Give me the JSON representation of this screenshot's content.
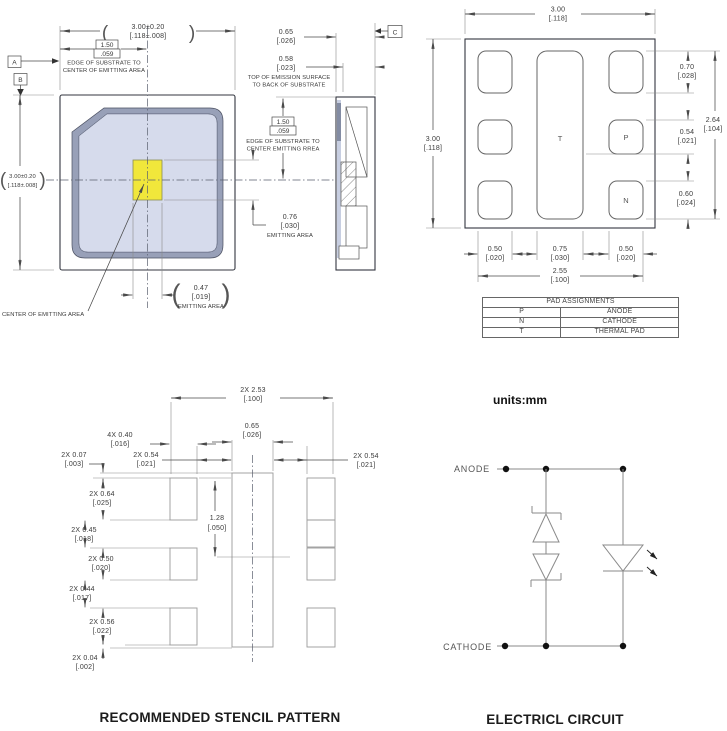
{
  "glyphs": {
    "po": "(",
    "pc": ")"
  },
  "top_view": {
    "datum_a": "A",
    "datum_b": "B",
    "dim_w": {
      "l1": "3.00±0.20",
      "l2": "[.118±.008]"
    },
    "dim_h": {
      "l1": "3.00±0.20",
      "l2": "[.118±.008]"
    },
    "edge_dim": {
      "l1": "1.50",
      "l2": ".059",
      "note1": "EDGE OF SUBSTRATE TO",
      "note2": "CENTER OF EMITTING AREA"
    },
    "emit_w": {
      "l1": "0.47",
      "l2": "[.019]",
      "l3": "EMITTING AREA"
    },
    "emit_h": {
      "l1": "0.76",
      "l2": "[.030]",
      "l3": "EMITTING AREA"
    },
    "center_note": "CENTER OF EMITTING AREA"
  },
  "side_view": {
    "datum_c": "C",
    "dim_t1": {
      "l1": "0.65",
      "l2": "[.026]"
    },
    "dim_t2": {
      "l1": "0.58",
      "l2": "[.023]"
    },
    "note1": "TOP OF EMISSION SURFACE",
    "note2": "TO BACK OF SUBSTRATE",
    "edge_dim": {
      "l1": "1.50",
      "l2": ".059",
      "note1": "EDGE OF SUBSTRATE TO",
      "note2": "CENTER EMITTING RREA"
    }
  },
  "pad_view": {
    "dim_w": {
      "l1": "3.00",
      "l2": "[.118]"
    },
    "dim_h": {
      "l1": "3.00",
      "l2": "[.118]"
    },
    "d070": {
      "l1": "0.70",
      "l2": "[.028]"
    },
    "d264": {
      "l1": "2.64",
      "l2": "[.104]"
    },
    "d054": {
      "l1": "0.54",
      "l2": "[.021]"
    },
    "d060": {
      "l1": "0.60",
      "l2": "[.024]"
    },
    "d050l": {
      "l1": "0.50",
      "l2": "[.020]"
    },
    "d075": {
      "l1": "0.75",
      "l2": "[.030]"
    },
    "d050r": {
      "l1": "0.50",
      "l2": "[.020]"
    },
    "d255": {
      "l1": "2.55",
      "l2": "[.100]"
    },
    "pad_t": "T",
    "pad_p": "P",
    "pad_n": "N",
    "table": {
      "title": "PAD ASSIGNMENTS",
      "rows": [
        {
          "pad": "P",
          "fn": "ANODE"
        },
        {
          "pad": "N",
          "fn": "CATHODE"
        },
        {
          "pad": "T",
          "fn": "THERMAL PAD"
        }
      ]
    }
  },
  "stencil": {
    "title": "RECOMMENDED STENCIL PATTERN",
    "d253": {
      "l1": "2X 2.53",
      "l2": "[.100]"
    },
    "d065": {
      "l1": "0.65",
      "l2": "[.026]"
    },
    "d040": {
      "l1": "4X 0.40",
      "l2": "[.016]"
    },
    "d054l": {
      "l1": "2X 0.54",
      "l2": "[.021]"
    },
    "d054r": {
      "l1": "2X 0.54",
      "l2": "[.021]"
    },
    "d128": {
      "l1": "1.28",
      "l2": "[.050]"
    },
    "d007": {
      "l1": "2X 0.07",
      "l2": "[.003]"
    },
    "d064": {
      "l1": "2X 0.64",
      "l2": "[.025]"
    },
    "d045": {
      "l1": "2X 0.45",
      "l2": "[.018]"
    },
    "d050": {
      "l1": "2X 0.50",
      "l2": "[.020]"
    },
    "d044": {
      "l1": "2X 0.44",
      "l2": "[.017]"
    },
    "d056": {
      "l1": "2X 0.56",
      "l2": "[.022]"
    },
    "d004": {
      "l1": "2X 0.04",
      "l2": "[.002]"
    }
  },
  "circuit": {
    "units": "units:mm",
    "anode": "ANODE",
    "cathode": "CATHODE",
    "title": "ELECTRICL CIRCUIT"
  },
  "colors": {
    "package_body": "#ccd3e7",
    "package_bevel": "#98a0b8",
    "package_recess": "#d6dbec",
    "emitting_area": "#f1e73b"
  }
}
